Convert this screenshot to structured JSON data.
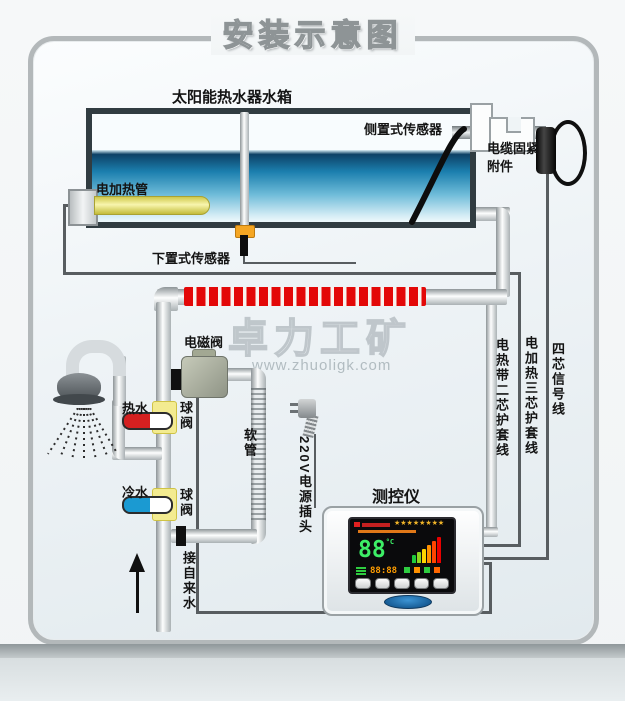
{
  "title": "安装示意图",
  "watermark": {
    "name": "卓力工矿",
    "url": "www.zhuoligk.com"
  },
  "tank": {
    "label": "太阳能热水器水箱",
    "side_sensor_label": "侧置式传感器",
    "bottom_sensor_label": "下置式传感器",
    "heater_label": "电加热管",
    "cable_fastener_label": "电缆固紧附件"
  },
  "plumbing": {
    "solenoid_valve_label": "电磁阀",
    "hot_water_label": "热水",
    "cold_water_label": "冷水",
    "ball_valve_label": "球阀",
    "soft_tube_label": "软管",
    "tap_water_label": "接自来水"
  },
  "power": {
    "plug_label": "220V电源插头"
  },
  "wires": {
    "heating_band_wire_label": "电热带二芯护套线",
    "heater_wire_label": "电加热三芯护套线",
    "signal_wire_label": "四芯信号线"
  },
  "controller": {
    "label": "测控仪",
    "stars": "★★★★★★★★",
    "temp_value": "88",
    "temp_unit": "°C",
    "time_value": "88:88"
  },
  "colors": {
    "heating_band_red": "#e30808",
    "hot_handle_red": "#d42020",
    "cold_handle_blue": "#1b9ad2",
    "valve_body_yellow": "#f3eb90",
    "screen_green": "#3dee66",
    "screen_orange": "#ff9d00",
    "badge_blue": "#155a93"
  }
}
